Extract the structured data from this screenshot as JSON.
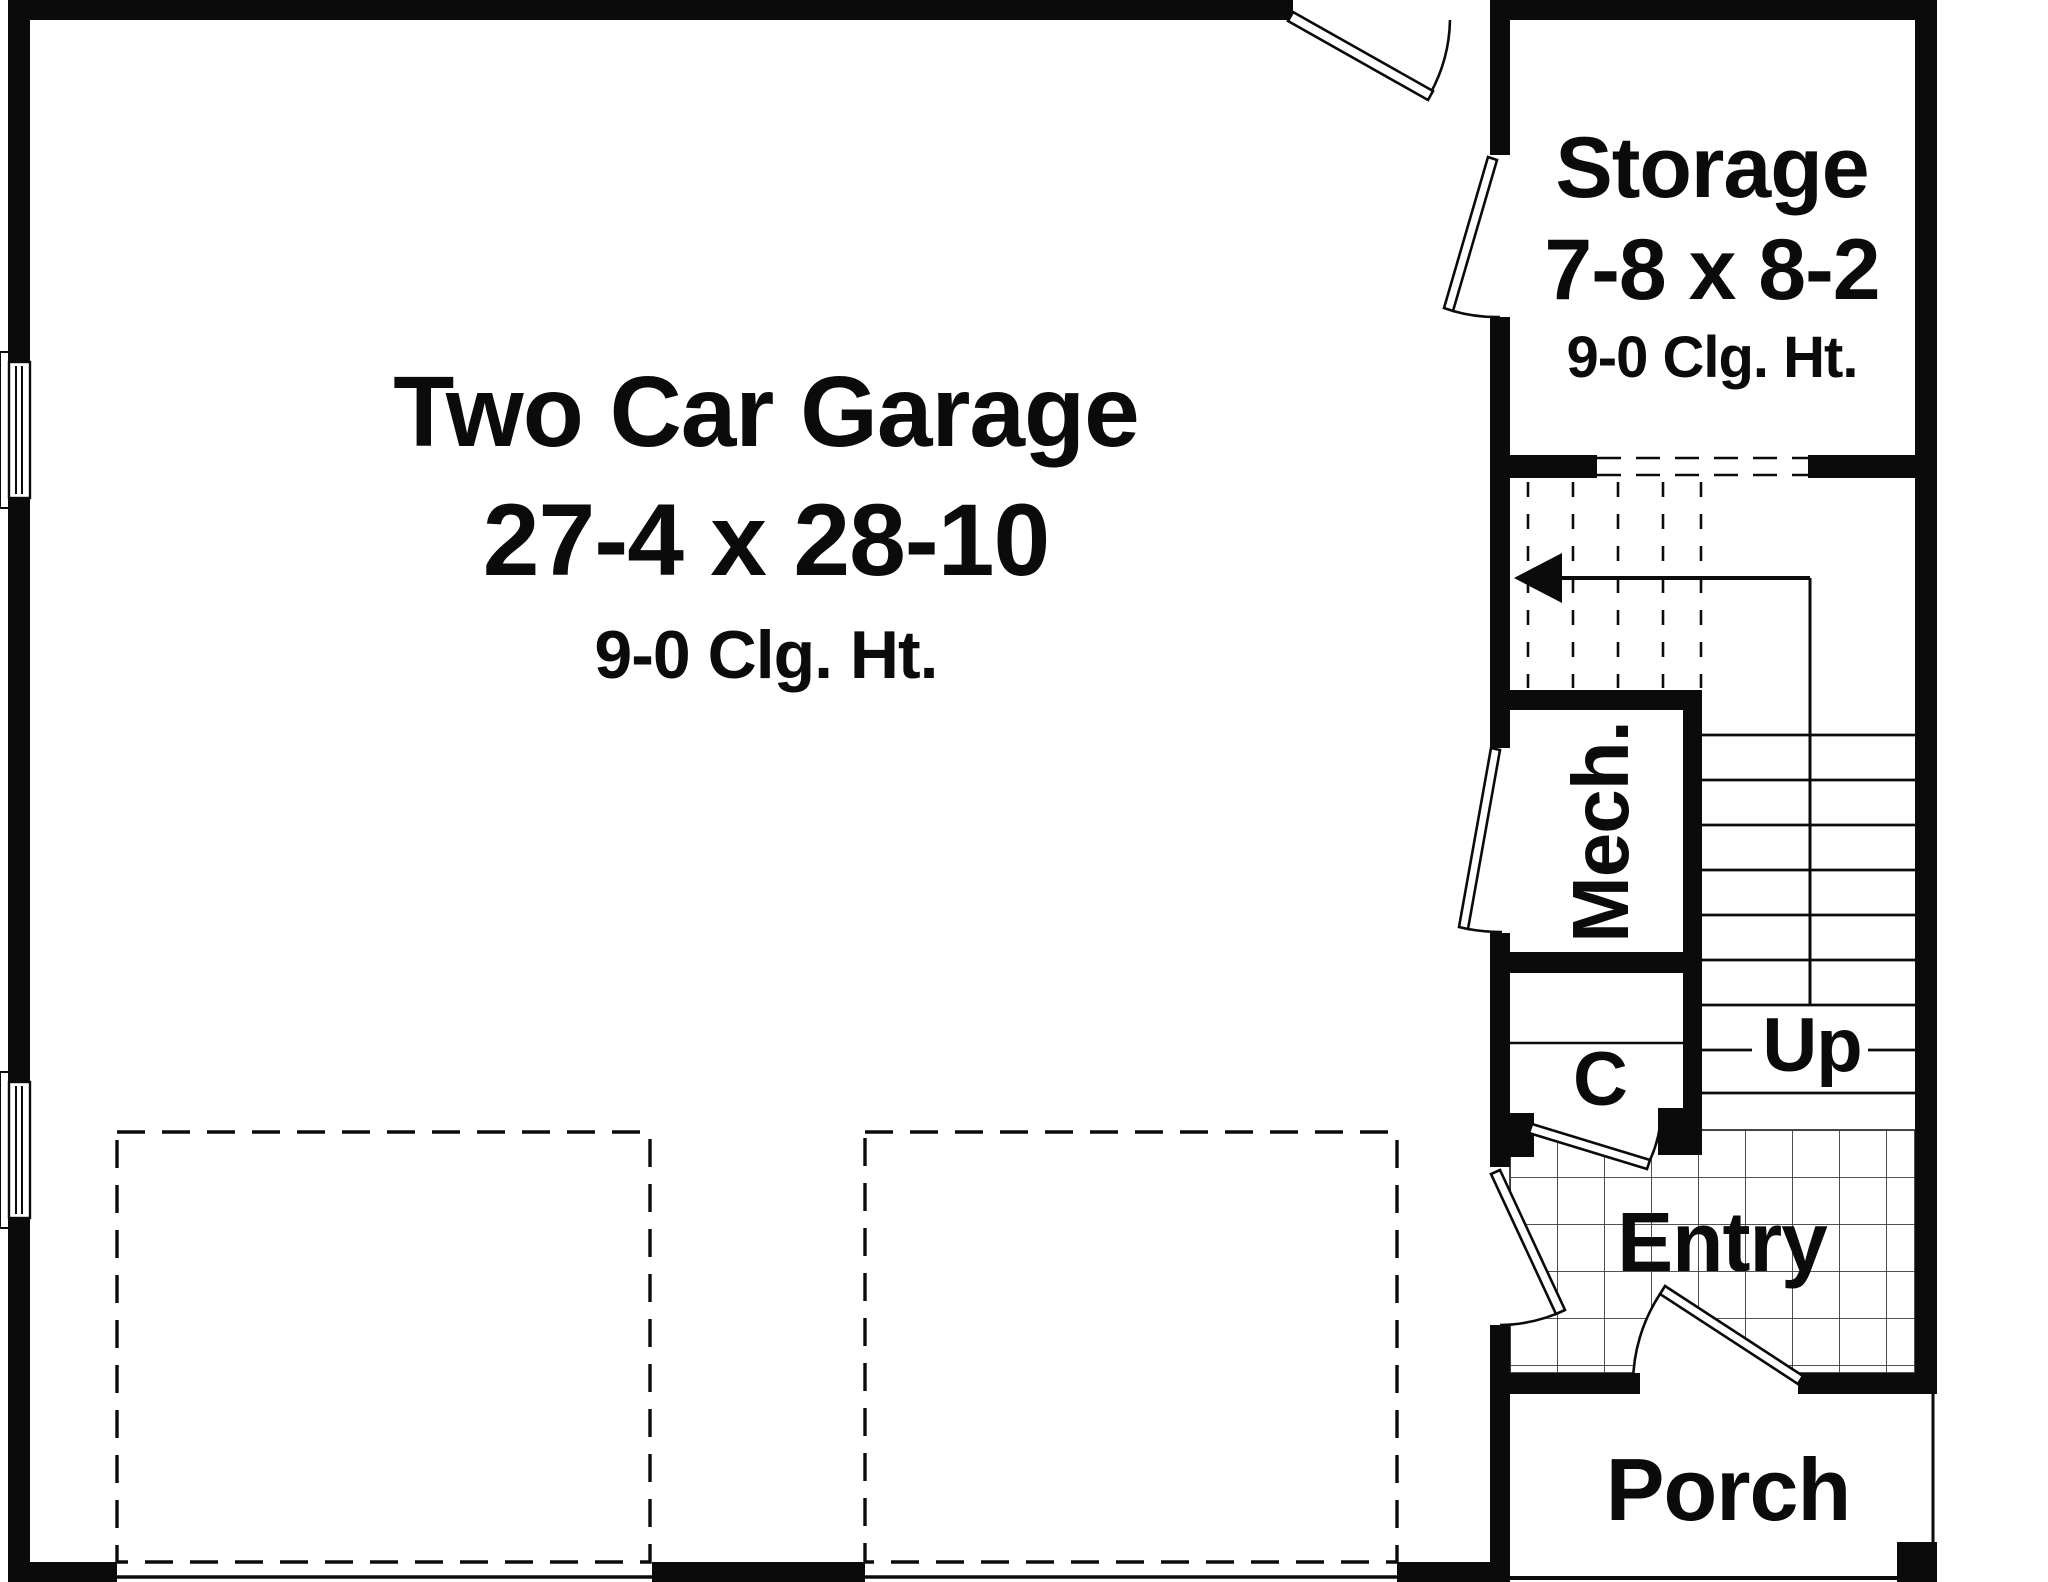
{
  "plan": {
    "title": "Garage floor plan",
    "colors": {
      "ink": "#0b0b0b",
      "paper": "#ffffff"
    },
    "rooms": {
      "garage": {
        "name": "Two Car Garage",
        "dims": "27-4 x 28-10",
        "ceiling": "9-0 Clg. Ht."
      },
      "storage": {
        "name": "Storage",
        "dims": "7-8 x 8-2",
        "ceiling": "9-0 Clg. Ht."
      },
      "mech": {
        "name": "Mech."
      },
      "closet": {
        "name": "C"
      },
      "entry": {
        "name": "Entry"
      },
      "porch": {
        "name": "Porch"
      },
      "stairs": {
        "direction_label": "Up"
      }
    }
  }
}
